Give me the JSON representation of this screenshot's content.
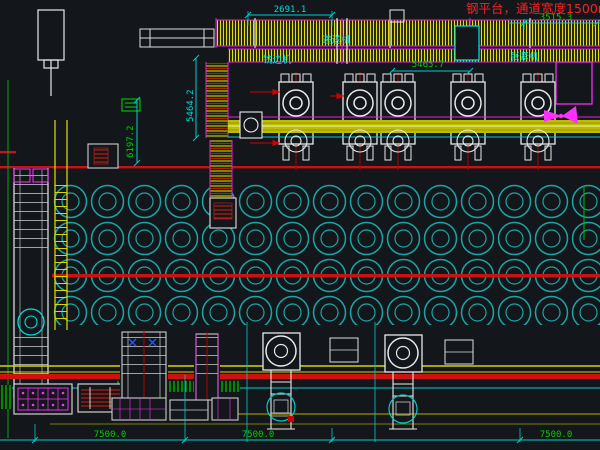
{
  "title": {
    "text": "钢平台，通道宽度1500mm"
  },
  "dims": {
    "top_left": "2691.1",
    "top_right": "3515.3",
    "mid": "5465.7",
    "vert_left_a": "5464.2",
    "vert_left_b": "6197.2",
    "bottom_left": "7500.0",
    "bottom_mid": "7500.0",
    "bottom_right": "7500.0"
  },
  "labels": {
    "machine_a": "铣边机",
    "machine_b": "递送机",
    "machine_c": "张紧机"
  },
  "colors": {
    "background": "#13171b",
    "hatch_yellow": "#e2e200",
    "rail_red": "#cc1111",
    "dim_cyan": "#00cccc",
    "dim_green": "#00d000",
    "detail_magenta": "#ff30ff",
    "storage_circle_teal": "#1aa5a5",
    "title_red": "#ff1f1f"
  }
}
